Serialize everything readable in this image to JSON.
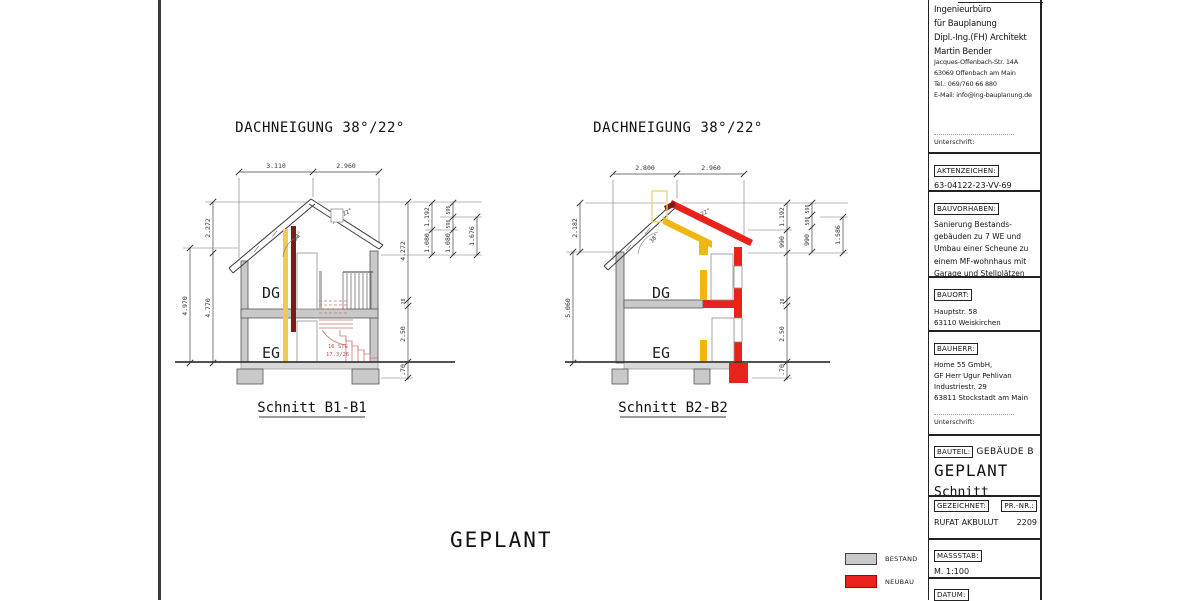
{
  "colors": {
    "bestand": "#c9c9c9",
    "neubau": "#e8221c",
    "beam_yellow": "#f2b613",
    "strip_yellow": "#eecb55",
    "dark_red": "#7a1d15",
    "stair_red": "#c87a74"
  },
  "footer_title": "GEPLANT",
  "legend": {
    "bestand": "BESTAND",
    "neubau": "NEUBAU"
  },
  "drawing1": {
    "title": "DACHNEIGUNG 38°/22°",
    "label": "Schnitt B1-B1",
    "floor_upper": "DG",
    "floor_lower": "EG",
    "angle_left": "38°",
    "angle_right": "22°",
    "stair_line1": "16 STG",
    "stair_line2": "17.3/26",
    "dims": {
      "top1": "3.110",
      "top2": "2.960",
      "left_top": "2.272",
      "left_outer": "4.970",
      "left_inner": "4.770",
      "right_main": "4.272",
      "slab": ".28",
      "eg_height": "2.50",
      "foundation": ".70",
      "c2a": "1.192",
      "c2b": "1.080",
      "c3a": "596",
      "c3b": "596",
      "c3c": "1.080",
      "c4": "1.676"
    }
  },
  "drawing2": {
    "title": "DACHNEIGUNG 38°/22°",
    "label": "Schnitt B2-B2",
    "floor_upper": "DG",
    "floor_lower": "EG",
    "angle_left": "38°",
    "angle_right": "22°",
    "dims": {
      "top1": "2.800",
      "top2": "2.960",
      "left_top": "2.182",
      "left_outer": "5.060",
      "right_a": "1.192",
      "right_b": "990",
      "slab": ".28",
      "eg_height": "2.50",
      "foundation": ".70",
      "c2a": "596",
      "c2b": "596",
      "c2c": "990",
      "c3": "1.586"
    }
  },
  "titleblock": {
    "firm": [
      "Ingenieurbüro",
      "für Bauplanung",
      "Dipl.-Ing.(FH) Architekt",
      "Martin Bender"
    ],
    "address": [
      "Jacques-Offenbach-Str. 14A",
      "63069 Offenbach am Main",
      "Tel.: 069/760 66 880",
      "E-Mail: info@ing-bauplanung.de"
    ],
    "unterschrift": "Unterschrift:",
    "aktenzeichen": {
      "label": "AKTENZEICHEN:",
      "value": "63-04122-23-VV-69"
    },
    "bauvorhaben": {
      "label": "BAUVORHABEN:",
      "lines": [
        "Sanierung Bestands-",
        "gebäuden zu 7 WE und",
        "Umbau einer Scheune zu",
        "einem MF-wohnhaus mit",
        "Garage und Stellplätzen"
      ]
    },
    "bauort": {
      "label": "BAUORT:",
      "lines": [
        "Hauptstr. 58",
        "63110 Weiskirchen"
      ]
    },
    "bauherr": {
      "label": "BAUHERR:",
      "lines": [
        "Home 55 GmbH,",
        "GF Herr Ugur Pehlivan",
        "Industriestr. 29",
        "63811 Stockstadt am Main"
      ]
    },
    "bauteil": {
      "label": "BAUTEIL:",
      "value": "GEBÄUDE B",
      "line2": "GEPLANT",
      "line3": "Schnitt"
    },
    "gezeichnet": {
      "label": "GEZEICHNET:",
      "value": "RUFAT AKBULUT"
    },
    "prnr": {
      "label": "PR.-NR.:",
      "value": "2209"
    },
    "massstab": {
      "label": "MASSSTAB:",
      "value": "M. 1:100"
    },
    "datum": {
      "label": "DATUM:"
    }
  }
}
